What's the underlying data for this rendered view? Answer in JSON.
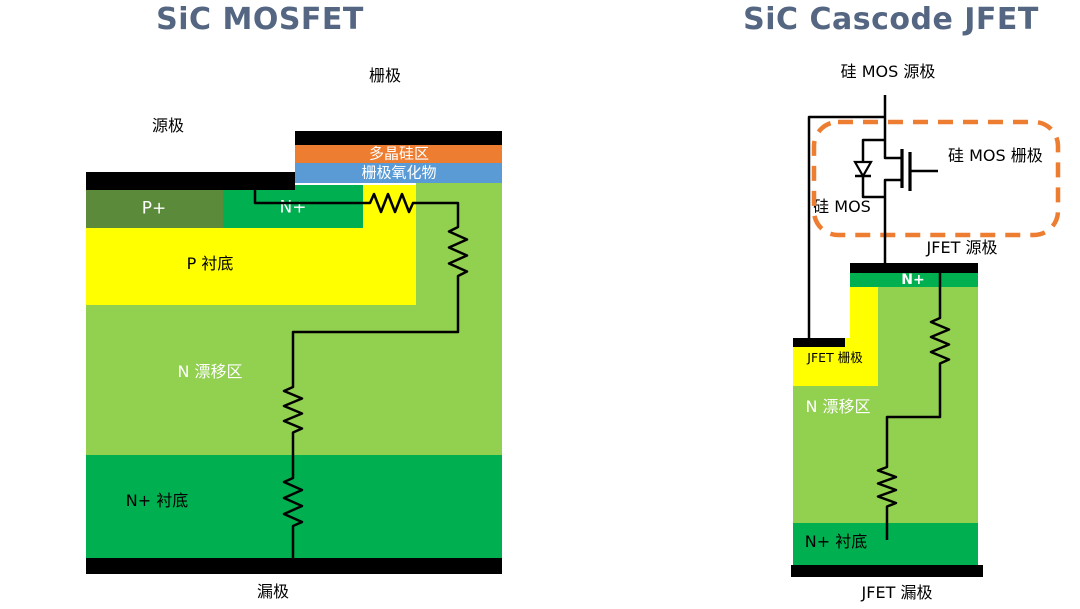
{
  "palette": {
    "background": "#FFFFFF",
    "title": "#546681",
    "black": "#000000",
    "wire": "#000000",
    "orange": "#ED7D31",
    "blue": "#5B9BD5",
    "dark_olive": "#5A8A3A",
    "green": "#00B050",
    "light_green": "#92D050",
    "yellow": "#FFFF00",
    "dashed_box": "#ED7D31"
  },
  "left": {
    "title": "SiC MOSFET",
    "gate": "栅极",
    "source": "源极",
    "drain": "漏极",
    "polysilicon": "多晶硅区",
    "gate_oxide": "栅极氧化物",
    "p_plus": "P+",
    "n_plus": "N+",
    "p_substrate": "P 衬底",
    "n_drift": "N 漂移区",
    "n_plus_substrate": "N+ 衬底"
  },
  "right": {
    "title": "SiC Cascode JFET",
    "si_mos_source": "硅 MOS 源极",
    "si_mos_gate": "硅 MOS 栅极",
    "si_mos": "硅 MOS",
    "jfet_source": "JFET 源极",
    "jfet_gate": "JFET 栅极",
    "jfet_drain": "JFET 漏极",
    "n_plus": "N+",
    "n_drift": "N 漂移区",
    "n_plus_substrate": "N+ 衬底"
  }
}
